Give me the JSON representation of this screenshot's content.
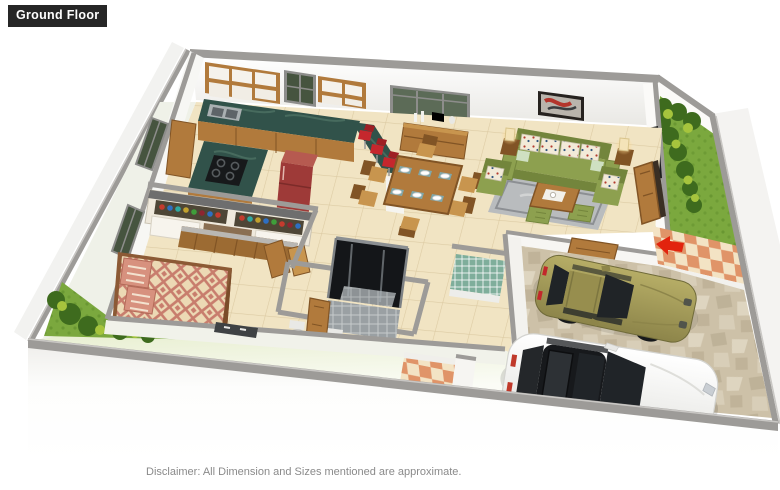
{
  "header": {
    "floor_label": "Ground Floor"
  },
  "footer": {
    "disclaimer": "Disclaimer: All Dimension and Sizes mentioned are approximate."
  },
  "palette": {
    "label_bg": "#262626",
    "label_text": "#ffffff",
    "disclaimer_text": "#8a8a8a",
    "wall_cap": "#9d9b98",
    "wall_cap_dark": "#8a8885",
    "wall_face": "#fbfaf8",
    "wall_shade": "#eceae6",
    "floor_beige": "#f1e4c3",
    "floor_line": "#d8c69d",
    "counter_green": "#31524a",
    "counter_green_lt": "#5d8372",
    "wood": "#b17a3c",
    "wood_dark": "#815425",
    "wood_light": "#c8954e",
    "fridge_red": "#9e3a38",
    "fridge_red_lt": "#b65a50",
    "stool_red": "#c5272d",
    "sofa_green": "#8da04f",
    "sofa_green_dark": "#73853c",
    "cushion_cream": "#f2ead8",
    "rug_gray": "#b9bcbe",
    "rug_gray_dark": "#8c8f93",
    "bed_rose": "#c87d6d",
    "bed_cream": "#ecd9b4",
    "grass": "#7ba83e",
    "grass_dark": "#5d8c2a",
    "bush_dark": "#3e6b1e",
    "bush_light": "#a6c43d",
    "stone_base": "#cdc1a8",
    "stone_dark": "#b3a68a",
    "stone_light": "#e2d9c5",
    "check_orange": "#e09468",
    "check_cream": "#f3e3c4",
    "car_white": "#f3f3f1",
    "car_olive": "#a39a58",
    "glass_dark": "#202427",
    "window_green": "#46543f",
    "arrow_red": "#e2230d",
    "tile_green": "#7fae9b",
    "tile_gray": "#9aa0a3",
    "yard_tint": "#e4ecc9",
    "lamp_glow": "#ffd98f"
  },
  "scene": {
    "type": "3d-isometric-floor-plan-render",
    "rooms": [
      {
        "name": "kitchen",
        "features": [
          "green-l-counter",
          "gas-stove",
          "sink",
          "upper-cabinets",
          "refrigerator",
          "breakfast-bar",
          "bar-stools",
          "crockery-shelf"
        ]
      },
      {
        "name": "dining-area",
        "features": [
          "six-seater-table",
          "sideboard",
          "window"
        ]
      },
      {
        "name": "living-room",
        "features": [
          "three-seater-sofa",
          "armchairs",
          "coffee-table",
          "rug",
          "ottomans",
          "table-lamps",
          "wall-art",
          "entrance-door"
        ]
      },
      {
        "name": "bedroom",
        "features": [
          "double-bed",
          "wardrobe",
          "windows"
        ]
      },
      {
        "name": "bathroom",
        "features": [
          "glass-shower",
          "toilets",
          "tiled-walls"
        ]
      },
      {
        "name": "porch",
        "features": [
          "checkered-tiles",
          "entry-arrow"
        ]
      },
      {
        "name": "garage",
        "features": [
          "stone-driveway",
          "white-sedan",
          "olive-hatchback"
        ]
      },
      {
        "name": "garden",
        "features": [
          "lawn-strips",
          "shrubs"
        ]
      }
    ]
  }
}
